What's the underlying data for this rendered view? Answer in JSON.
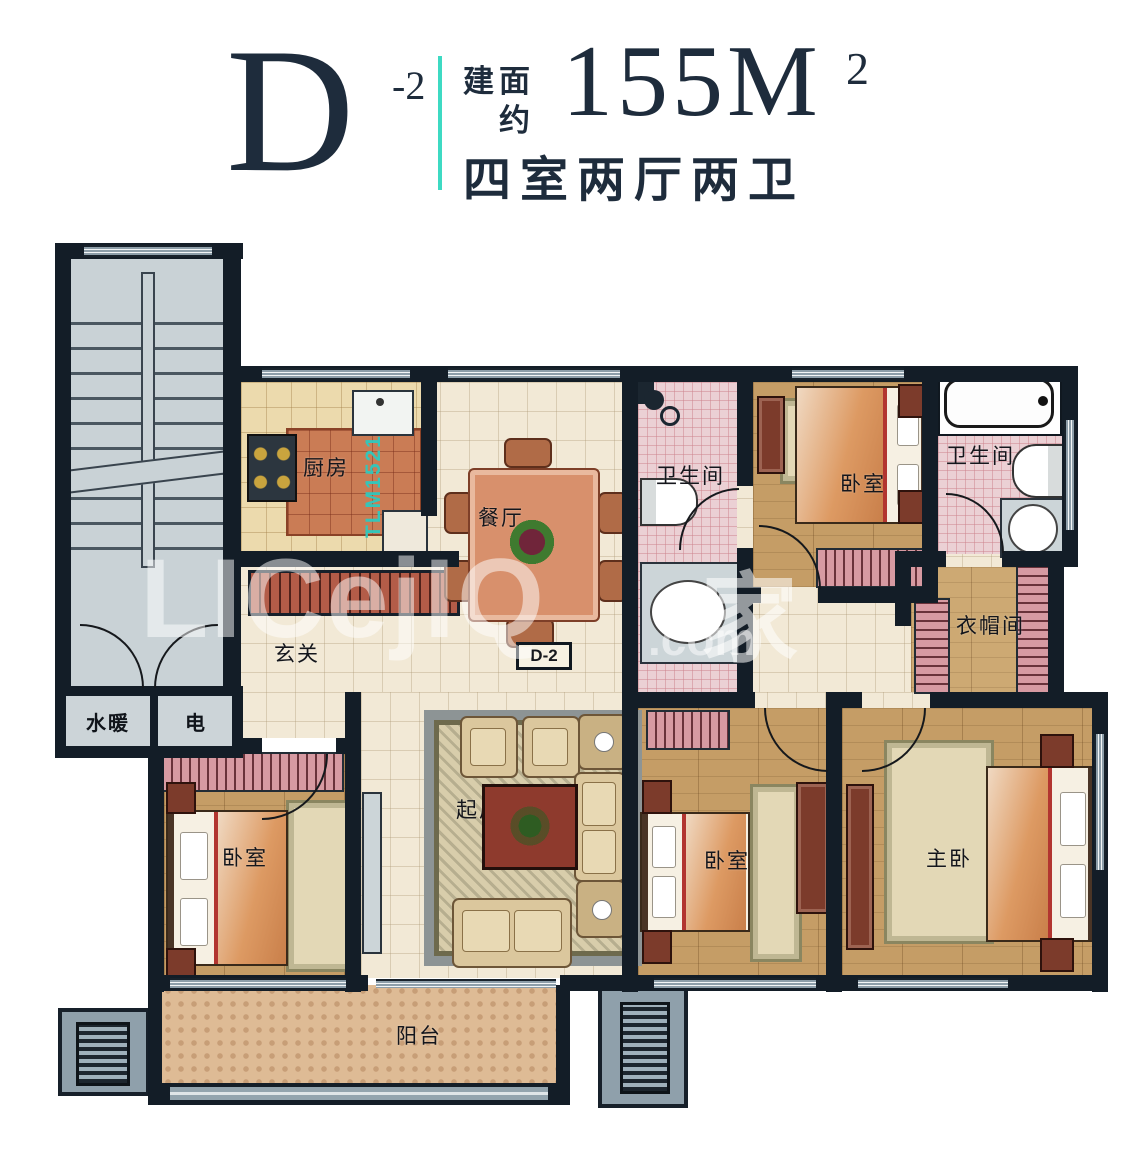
{
  "header": {
    "unit_letter": "D",
    "unit_sup": "-2",
    "area_prefix_top": "建面",
    "area_prefix_bottom": "约",
    "area_value": "155M",
    "area_sup": "2",
    "subtitle": "四室两厅两卫"
  },
  "plan": {
    "unit_tag": "D-2",
    "rooms": {
      "kitchen": "厨房",
      "dining": "餐厅",
      "foyer": "玄关",
      "living": "起居室",
      "balcony": "阳台",
      "bath_middle": "卫生间",
      "bath_right": "卫生间",
      "bedroom_top_right": "卧室",
      "bedroom_bottom_left": "卧室",
      "bedroom_bottom_center": "卧室",
      "master_bedroom": "主卧",
      "cloakroom": "衣帽间",
      "shaft_water": "水暖",
      "shaft_electric": "电"
    },
    "watermarks": {
      "code": "TLM1521",
      "site_latin": "LICejIQ",
      "site_suffix": ".com",
      "site_cjk": "家"
    }
  },
  "colors": {
    "accent_teal": "#3DDAC3",
    "title_navy": "#1E2C3C"
  }
}
